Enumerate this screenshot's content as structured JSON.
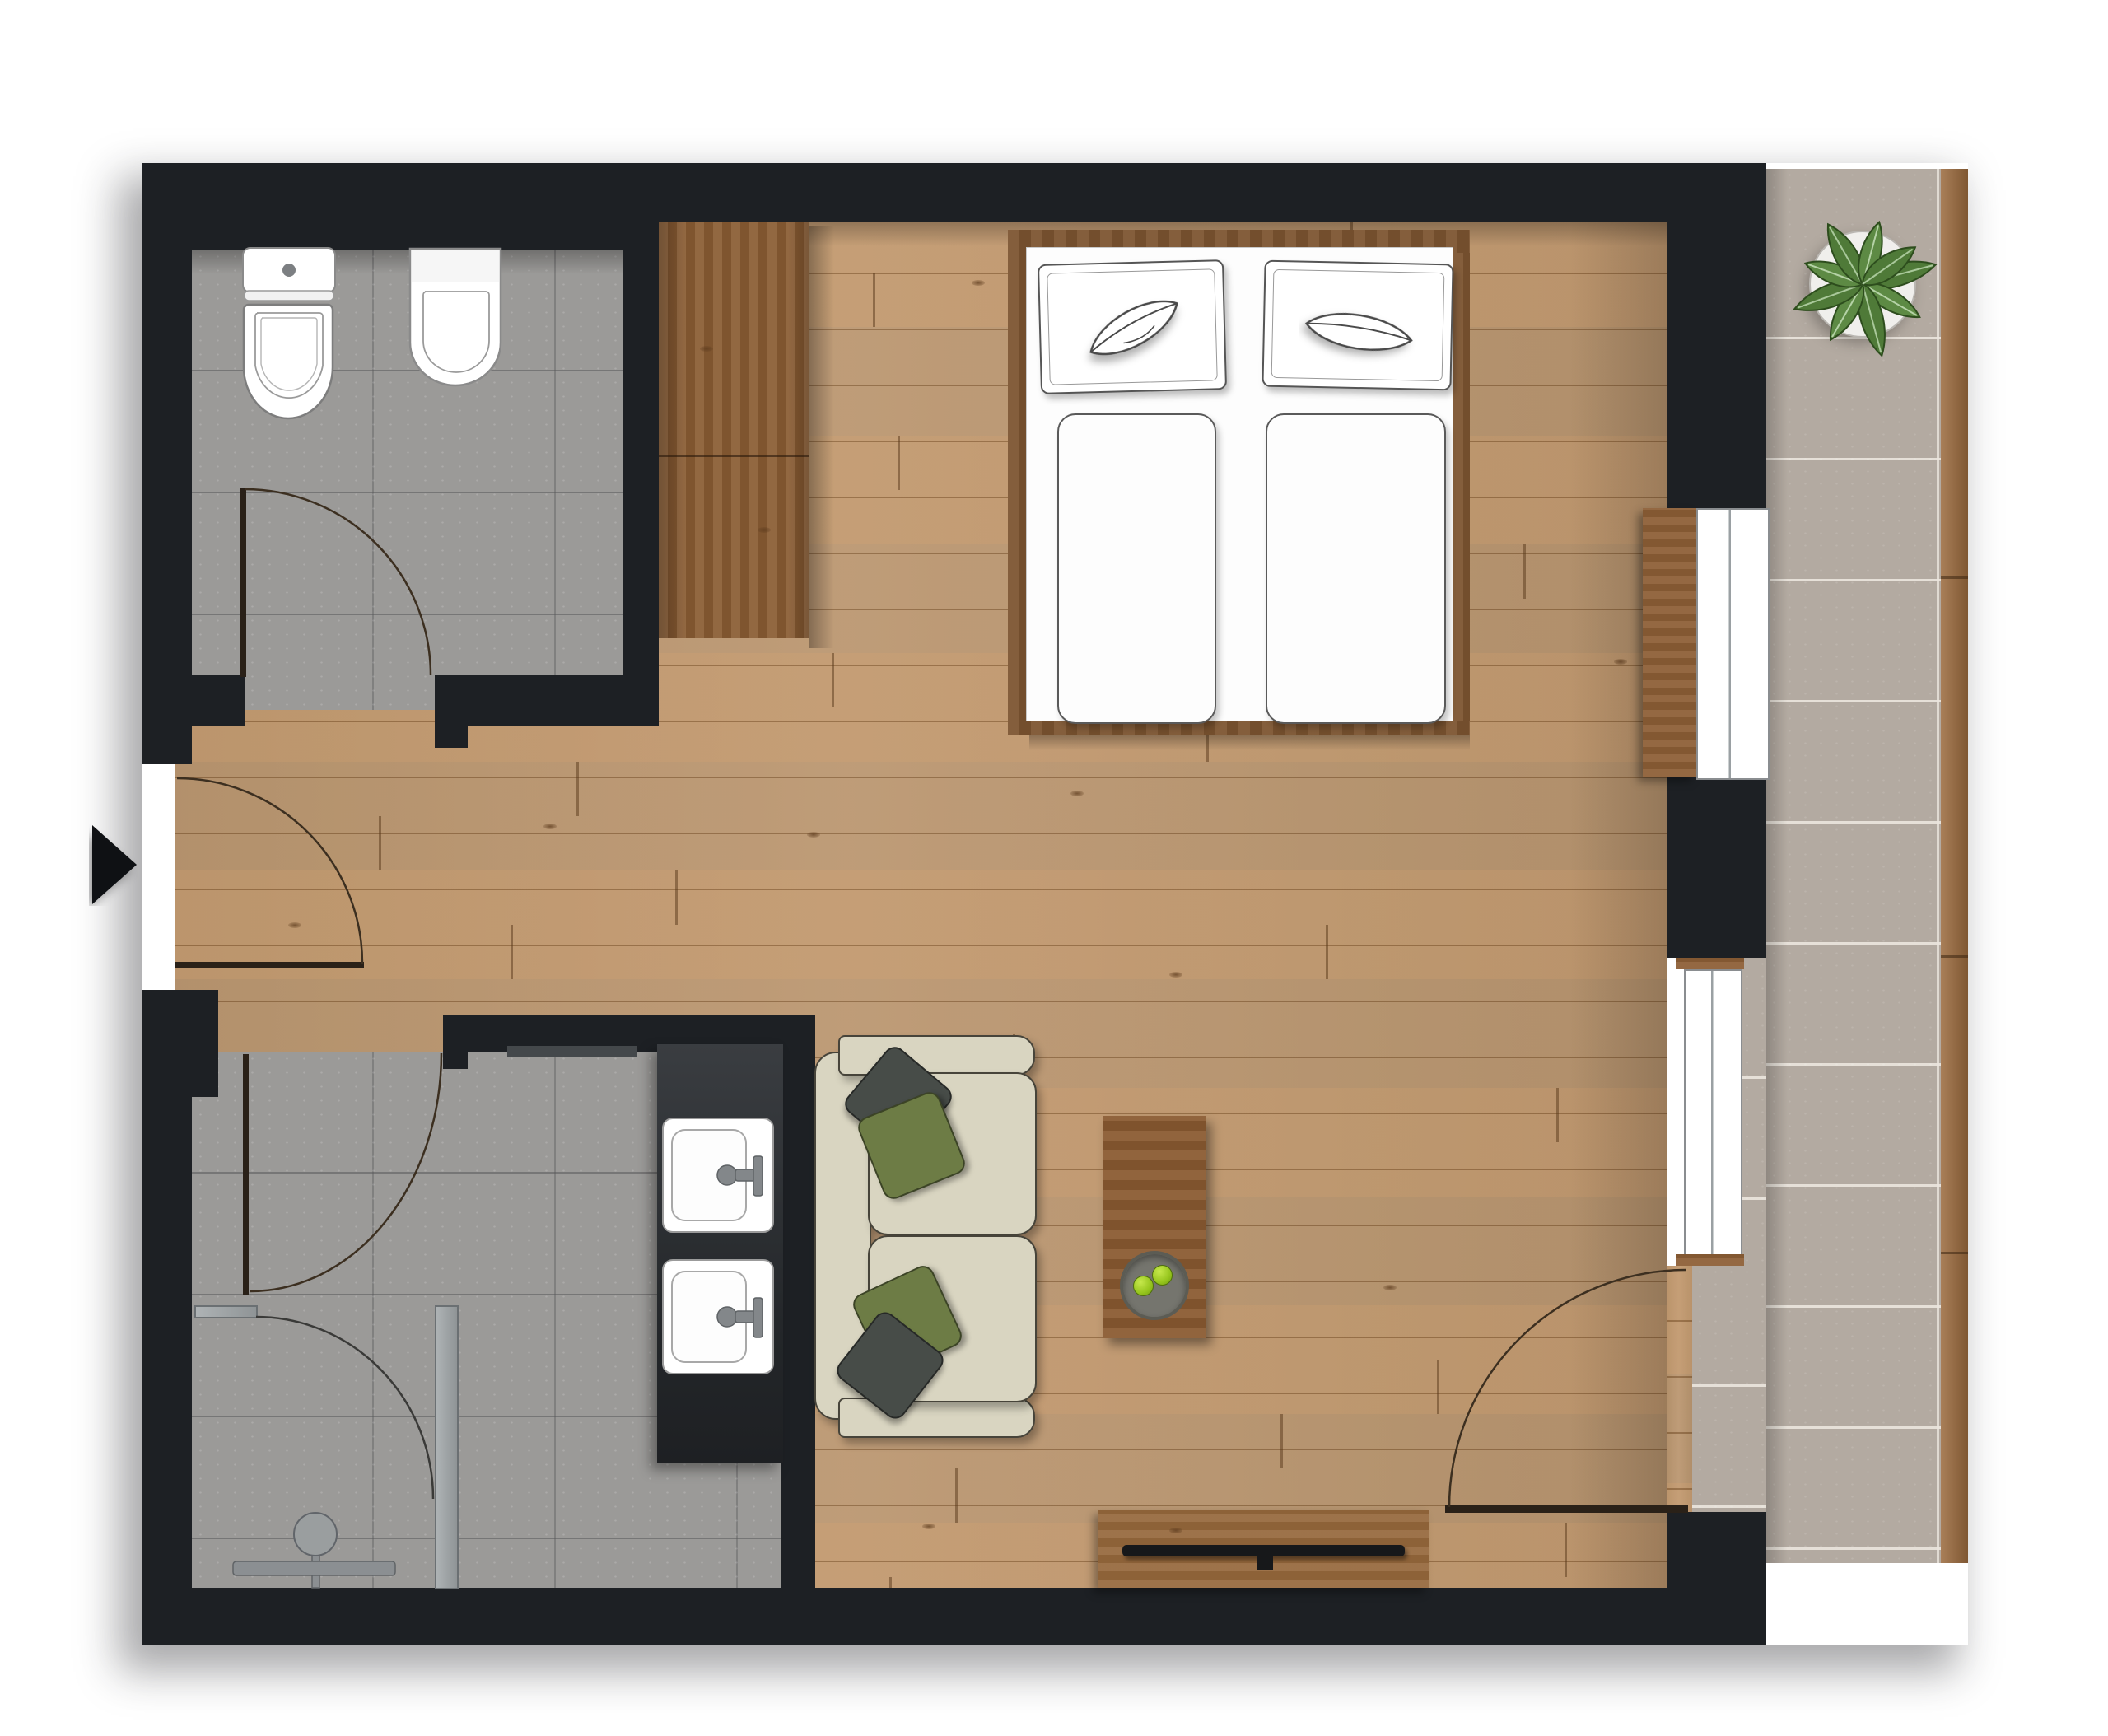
{
  "meta": {
    "title": "studio-apartment-floor-plan",
    "view": "top-down",
    "type": "architectural-floor-plan"
  },
  "palette": {
    "wall": "#1d2024",
    "wood_floor": "#bf9466",
    "dark_wood": "#8d5f36",
    "bathroom_tile": "#9b9a98",
    "balcony_tile": "#b3aaa1",
    "deck_wood": "#9b6a3d",
    "sofa_beige": "#d9d5c1",
    "pillow_olive": "#6d7c45",
    "pillow_charcoal": "#474c48",
    "fixture_white": "#ffffff",
    "glass_gray": "#9aa0a2",
    "counter_dark": "#2c2f33",
    "plant_green": "#4f7a38",
    "apple_green": "#96c51d",
    "entry_arrow": "#0f1114"
  },
  "rooms": {
    "bathroom_top": {
      "label": "WC bathroom",
      "floor": "gray stone tile",
      "fixtures": [
        "toilet with cistern",
        "wall-hung toilet"
      ]
    },
    "bathroom_bottom": {
      "label": "Shower bathroom",
      "floor": "gray stone tile",
      "fixtures": [
        "walk-in shower",
        "double vanity with two sinks",
        "glass partition"
      ]
    },
    "hallway": {
      "label": "Entry hallway",
      "floor": "oak plank"
    },
    "living_bedroom": {
      "label": "Living and sleeping room",
      "floor": "oak plank",
      "furniture": [
        "double bed",
        "wardrobe",
        "two-seat sofa",
        "coffee table",
        "tv sideboard",
        "window console"
      ]
    },
    "balcony": {
      "label": "Balcony",
      "floor": "stone tile with deck board edge",
      "furniture": [
        "potted plant"
      ]
    }
  },
  "furniture": {
    "bed": {
      "pillows": 2,
      "duvets": 2,
      "pillow_motifs": [
        "leaf sketch",
        "lips sketch"
      ]
    },
    "sofa": {
      "seats": 2,
      "cushions": 4,
      "cushion_colors": [
        "charcoal",
        "olive",
        "olive",
        "charcoal"
      ]
    },
    "coffee_table": {
      "items": [
        "gray bowl",
        "2 green apples"
      ]
    },
    "tv_sideboard": {
      "items": [
        "flat tv / soundbar"
      ]
    },
    "wardrobe": {
      "material": "dark oak"
    },
    "window_console": {
      "material": "dark oak"
    }
  },
  "doors": [
    {
      "name": "entry-door",
      "location": "left wall",
      "state": "open with swing arc"
    },
    {
      "name": "bathroom-top-door",
      "location": "bathroom bottom wall",
      "state": "open with swing arc"
    },
    {
      "name": "bathroom-bottom-door",
      "location": "bathroom top wall",
      "state": "open with swing arc"
    },
    {
      "name": "shower-glass-door",
      "location": "inside lower bathroom",
      "state": "open with swing arc"
    },
    {
      "name": "balcony-door",
      "location": "right wall",
      "state": "open with swing arc"
    }
  ],
  "windows": [
    {
      "name": "window-1",
      "location": "right wall upper"
    },
    {
      "name": "window-2",
      "location": "right wall lower"
    }
  ],
  "icons": [
    {
      "name": "entry-arrow-icon",
      "meaning": "entrance direction"
    },
    {
      "name": "shower-head-icon",
      "meaning": "shower fixture"
    },
    {
      "name": "plant-icon",
      "meaning": "potted calathea plant"
    }
  ]
}
